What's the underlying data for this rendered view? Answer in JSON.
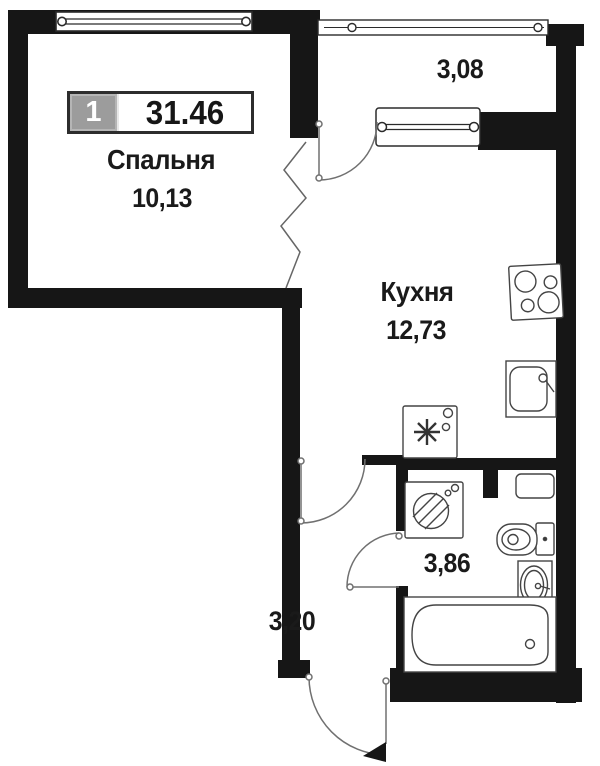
{
  "badge": {
    "room_count": "1",
    "total_area": "31.46"
  },
  "rooms": {
    "bedroom": {
      "name": "Спальня",
      "area": "10,13"
    },
    "kitchen": {
      "name": "Кухня",
      "area": "12,73"
    },
    "balcony": {
      "area": "3,08"
    },
    "bathroom": {
      "area": "3,86"
    },
    "hallway": {
      "area": "3,20"
    }
  },
  "windows": [
    "bedroom-window",
    "balcony-glazing",
    "kitchen-window"
  ],
  "doors": [
    "balcony-door",
    "kitchen-hallway-door",
    "bathroom-door",
    "entrance-door"
  ],
  "fixtures": [
    "stove",
    "kitchen-sink",
    "refrigerator",
    "washing-machine",
    "cabinet",
    "toilet",
    "bathroom-sink",
    "bathtub",
    "ventilation-shaft"
  ],
  "colors": {
    "wall": "#161616",
    "fixture_line": "#444444",
    "door_line": "#707070",
    "text": "#1a1a1a",
    "badge_grey": "#9c9c9c",
    "badge_border": "#2d2d2d",
    "background": "#ffffff"
  }
}
